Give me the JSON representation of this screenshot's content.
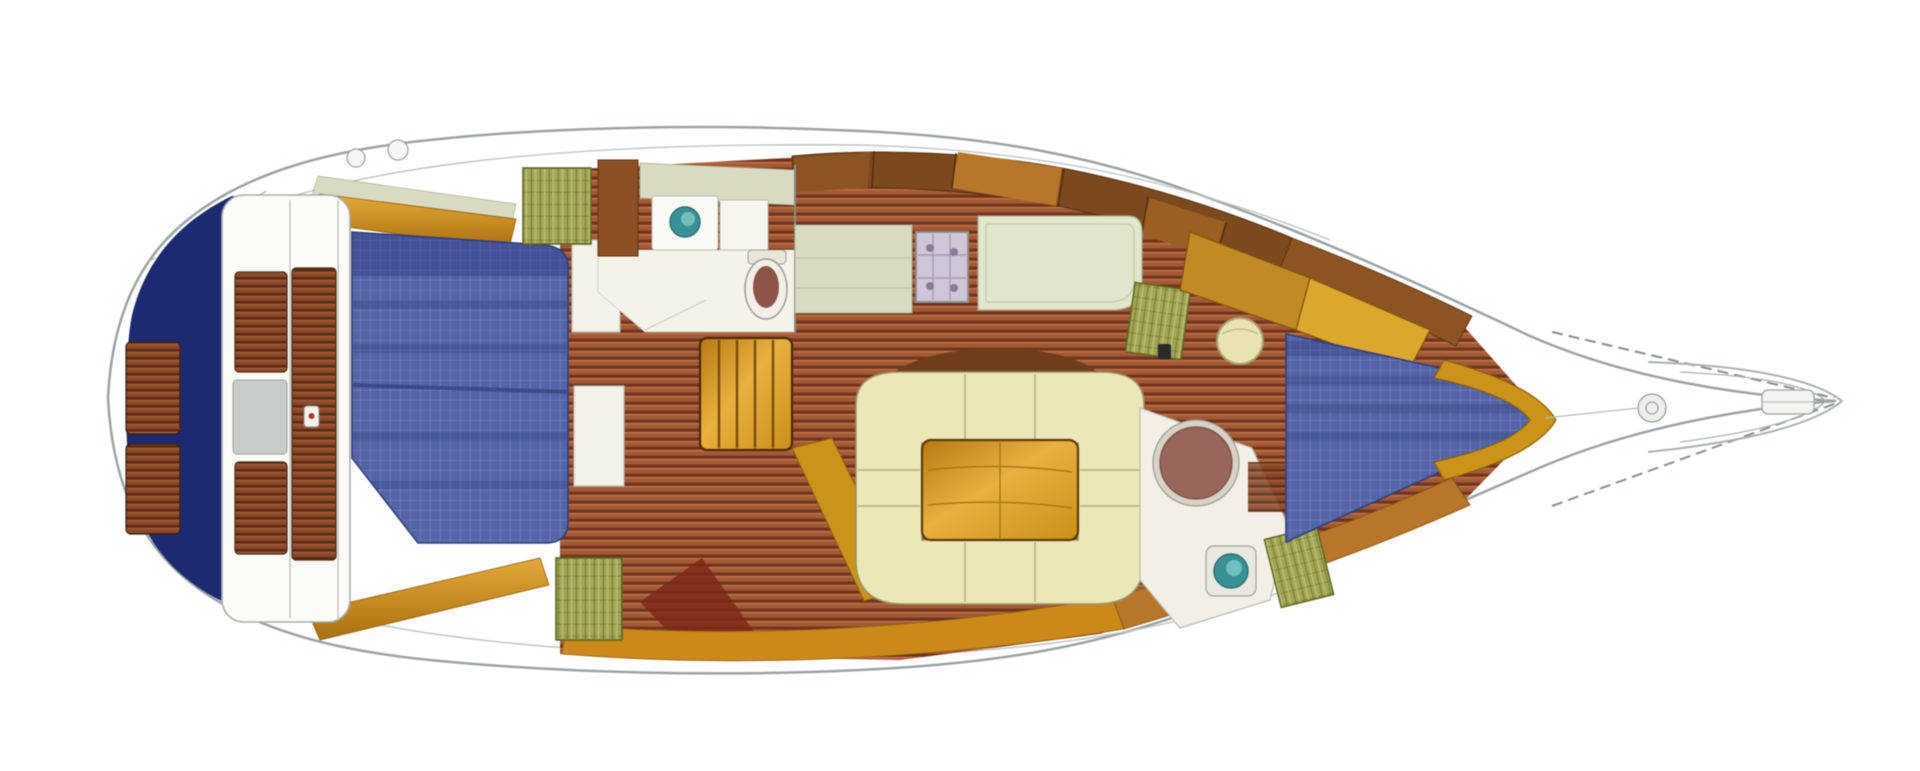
{
  "diagram": {
    "type": "sailboat-interior-floor-plan",
    "view": "overhead",
    "bow_direction": "right",
    "stern_direction": "left",
    "regions": [
      "swim-platform",
      "stern-transom",
      "cockpit",
      "cockpit-bench-port",
      "cockpit-bench-starboard",
      "aft-cabin-double-berth",
      "aft-head",
      "companionway-steps",
      "galley",
      "stove",
      "nav-station",
      "hanging-lockers",
      "salon-settee",
      "salon-table",
      "mast-post",
      "forward-head",
      "shower",
      "forward-cabin-v-berth",
      "bow-deck",
      "bow-pulpit"
    ],
    "berth_count": 2,
    "head_count": 2,
    "sink_count": 2
  },
  "colors": {
    "page_bg": "#ffffff",
    "hull_fill": "#ffffff",
    "hull_outline": "#9aa3a3",
    "transom_navy": "#1c2a6e",
    "berth_blue": "#5464a4",
    "berth_grid_line": "#7e8cc6",
    "floor_brown": "#a05a38",
    "teak_brown": "#8a4a2c",
    "coaming_gold": "#c8891e",
    "cabinet_wood": "#7a4820",
    "settee_cream": "#ece7b8",
    "table_gold": "#d29a2e",
    "counter_sage": "#d8dbc2",
    "desk_sage": "#e3e6cf",
    "sink_teal": "#3d9094",
    "toilet_brown": "#8a5548",
    "shower_brown": "#96655c",
    "hatch_green": "#a3a458",
    "stove_lavender": "#cfc6d6",
    "pouf_cream": "#e9e3b4"
  }
}
